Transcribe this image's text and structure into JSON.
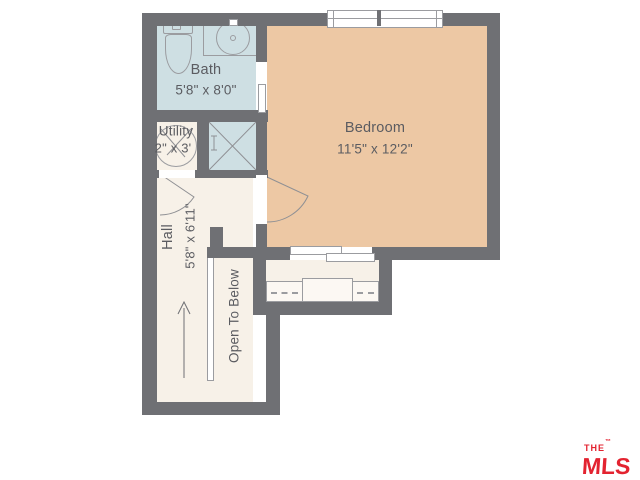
{
  "colors": {
    "wall": "#6f7074",
    "bath": "#cedfe3",
    "bedroom": "#edc8a4",
    "floor": "#f7f1e8",
    "line": "#9b9ca0",
    "text": "#5b5c61",
    "logo_red": "#e32330"
  },
  "rooms": {
    "bath": {
      "name": "Bath",
      "dims": "5'8\" x 8'0\""
    },
    "utility": {
      "name": "Utility",
      "dims": "2\" x 3'"
    },
    "bedroom": {
      "name": "Bedroom",
      "dims": "11'5\" x 12'2\""
    },
    "hall": {
      "name": "Hall",
      "dims": "5'8\" x 6'11\""
    }
  },
  "annotations": {
    "stairwell": "Open To Below"
  },
  "logo": {
    "the": "THE",
    "mls": "MLS",
    "com": ".COM",
    "tm": "™"
  }
}
